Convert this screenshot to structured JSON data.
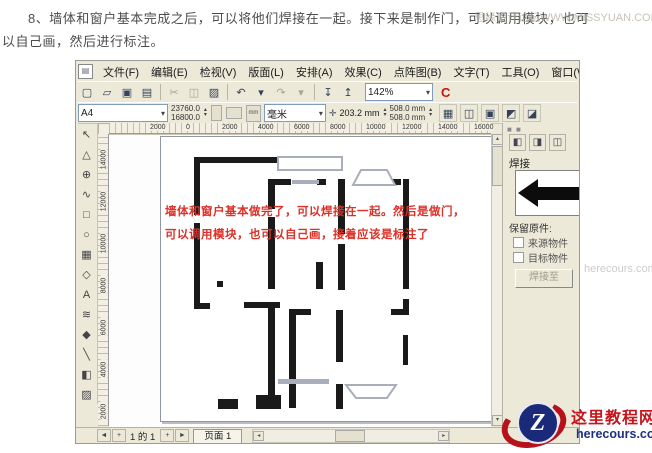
{
  "page": {
    "intro_line1": "8、墙体和窗户基本完成之后，可以将他们焊接在一起。接下来是制作门，可以调用模块，也可",
    "intro_line2": "以自己画，然后进行标注。",
    "watermark": "思缘设计论坛WWW.MISSYUAN.COM",
    "side_watermark": "herecours.com"
  },
  "app": {
    "menu": [
      "文件(F)",
      "编辑(E)",
      "检视(V)",
      "版面(L)",
      "安排(A)",
      "效果(C)",
      "点阵图(B)",
      "文字(T)",
      "工具(O)",
      "窗口(W)",
      "帮助(H)"
    ],
    "toolbar": {
      "zoom_level": "142%",
      "launcher_label": "C",
      "icons": [
        {
          "name": "new-icon",
          "glyph": "▢"
        },
        {
          "name": "open-icon",
          "glyph": "▱"
        },
        {
          "name": "save-icon",
          "glyph": "▣"
        },
        {
          "name": "print-icon",
          "glyph": "▤"
        },
        {
          "name": "sep"
        },
        {
          "name": "cut-icon",
          "glyph": "✂",
          "dim": true
        },
        {
          "name": "copy-icon",
          "glyph": "◫",
          "dim": true
        },
        {
          "name": "paste-icon",
          "glyph": "▨"
        },
        {
          "name": "sep"
        },
        {
          "name": "undo-icon",
          "glyph": "↶"
        },
        {
          "name": "undo-dropdown-icon",
          "glyph": "▾"
        },
        {
          "name": "redo-icon",
          "glyph": "↷",
          "dim": true
        },
        {
          "name": "redo-dropdown-icon",
          "glyph": "▾",
          "dim": true
        },
        {
          "name": "sep"
        },
        {
          "name": "import-icon",
          "glyph": "↧"
        },
        {
          "name": "export-icon",
          "glyph": "↥"
        }
      ]
    },
    "property_bar": {
      "paper_type": "A4",
      "paper_width": "23760.0",
      "paper_height": "16800.0",
      "units_badge": "mm",
      "units": "毫米",
      "nudge_icon": "✛",
      "nudge": "203.2 mm",
      "duplicate_x": "508.0 mm",
      "duplicate_y": "508.0 mm",
      "snap_icons": [
        {
          "name": "snap-grid-icon",
          "glyph": "▦"
        },
        {
          "name": "snap-guideline-icon",
          "glyph": "◫"
        },
        {
          "name": "snap-object-icon",
          "glyph": "▣"
        },
        {
          "name": "treat-as-filled-icon",
          "glyph": "◩"
        },
        {
          "name": "bounding-box-icon",
          "glyph": "◪"
        }
      ]
    },
    "toolbox": [
      {
        "name": "pick-tool",
        "glyph": "↖"
      },
      {
        "name": "shape-tool",
        "glyph": "△"
      },
      {
        "name": "zoom-tool",
        "glyph": "⊕"
      },
      {
        "name": "freehand-tool",
        "glyph": "∿"
      },
      {
        "name": "rectangle-tool",
        "glyph": "□"
      },
      {
        "name": "ellipse-tool",
        "glyph": "○"
      },
      {
        "name": "graph-paper-tool",
        "glyph": "▦"
      },
      {
        "name": "polygon-tool",
        "glyph": "◇"
      },
      {
        "name": "text-tool",
        "glyph": "A"
      },
      {
        "name": "interactive-blend-tool",
        "glyph": "≋"
      },
      {
        "name": "eyedropper-tool",
        "glyph": "◆"
      },
      {
        "name": "outline-tool",
        "glyph": "╲"
      },
      {
        "name": "fill-tool",
        "glyph": "◧"
      },
      {
        "name": "interactive-fill-tool",
        "glyph": "▨"
      }
    ],
    "rulers": {
      "h_ticks": [
        "2000",
        "0",
        "2000",
        "4000",
        "6000",
        "8000",
        "10000",
        "12000",
        "14000",
        "16000"
      ],
      "v_ticks": [
        "14000",
        "12000",
        "10000",
        "8000",
        "6000",
        "4000",
        "2000"
      ]
    },
    "canvas": {
      "annotation_line1": "墙体和窗户基本做完了，可以焊接在一起。然后是做门，",
      "annotation_line2": "可以调用模块，也可以自己画，接着应该是标注了",
      "annotation_color": "#dc3028",
      "floorplan": {
        "wall_color": "#1a1a1a",
        "window_color": "#a8aeba",
        "walls": [
          [
            43,
            25,
            88,
            6
          ],
          [
            43,
            25,
            6,
            58
          ],
          [
            43,
            91,
            6,
            86
          ],
          [
            43,
            171,
            16,
            6
          ],
          [
            66,
            149,
            6,
            6
          ],
          [
            117,
            47,
            7,
            30
          ],
          [
            117,
            85,
            7,
            72
          ],
          [
            117,
            173,
            7,
            100
          ],
          [
            124,
            47,
            16,
            6
          ],
          [
            166,
            47,
            9,
            6
          ],
          [
            187,
            47,
            7,
            55
          ],
          [
            187,
            112,
            7,
            46
          ],
          [
            242,
            47,
            8,
            6
          ],
          [
            252,
            47,
            6,
            110
          ],
          [
            252,
            167,
            6,
            16
          ],
          [
            240,
            177,
            18,
            6
          ],
          [
            93,
            170,
            36,
            6
          ],
          [
            138,
            177,
            22,
            6
          ],
          [
            138,
            183,
            7,
            93
          ],
          [
            165,
            130,
            7,
            27
          ],
          [
            185,
            178,
            7,
            52
          ],
          [
            67,
            267,
            20,
            10
          ],
          [
            105,
            263,
            25,
            14
          ],
          [
            185,
            252,
            7,
            25
          ],
          [
            252,
            203,
            5,
            30
          ]
        ],
        "window_rects": [
          [
            127,
            25,
            64,
            13
          ],
          [
            141,
            48,
            27,
            4
          ],
          [
            127,
            247,
            51,
            5
          ]
        ],
        "bay_polygons": [
          "202,53 210,38 236,38 244,53",
          "195,253 205,266 236,266 245,253"
        ]
      }
    },
    "docker": {
      "shape_icons": [
        {
          "name": "weld-icon",
          "glyph": "◧"
        },
        {
          "name": "trim-icon",
          "glyph": "◨"
        },
        {
          "name": "intersect-icon",
          "glyph": "◫"
        }
      ],
      "title": "焊接",
      "keep_label": "保留原件:",
      "source_label": "来源物件",
      "target_label": "目标物件",
      "weld_button": "焊接至"
    },
    "pagebar": {
      "nav_icons": [
        {
          "name": "first-page-icon",
          "glyph": "◄"
        },
        {
          "name": "add-page-before-icon",
          "glyph": "+"
        }
      ],
      "page_indicator": "1 的 1",
      "nav_icons_after": [
        {
          "name": "add-page-after-icon",
          "glyph": "+"
        },
        {
          "name": "last-page-icon",
          "glyph": "►"
        }
      ],
      "page_tab": "页面  1"
    }
  },
  "logo": {
    "badge_letter": "Z",
    "site_name": "这里教程网",
    "site_url": "herecours.com",
    "red": "#c5161d",
    "blue": "#1d3080"
  }
}
